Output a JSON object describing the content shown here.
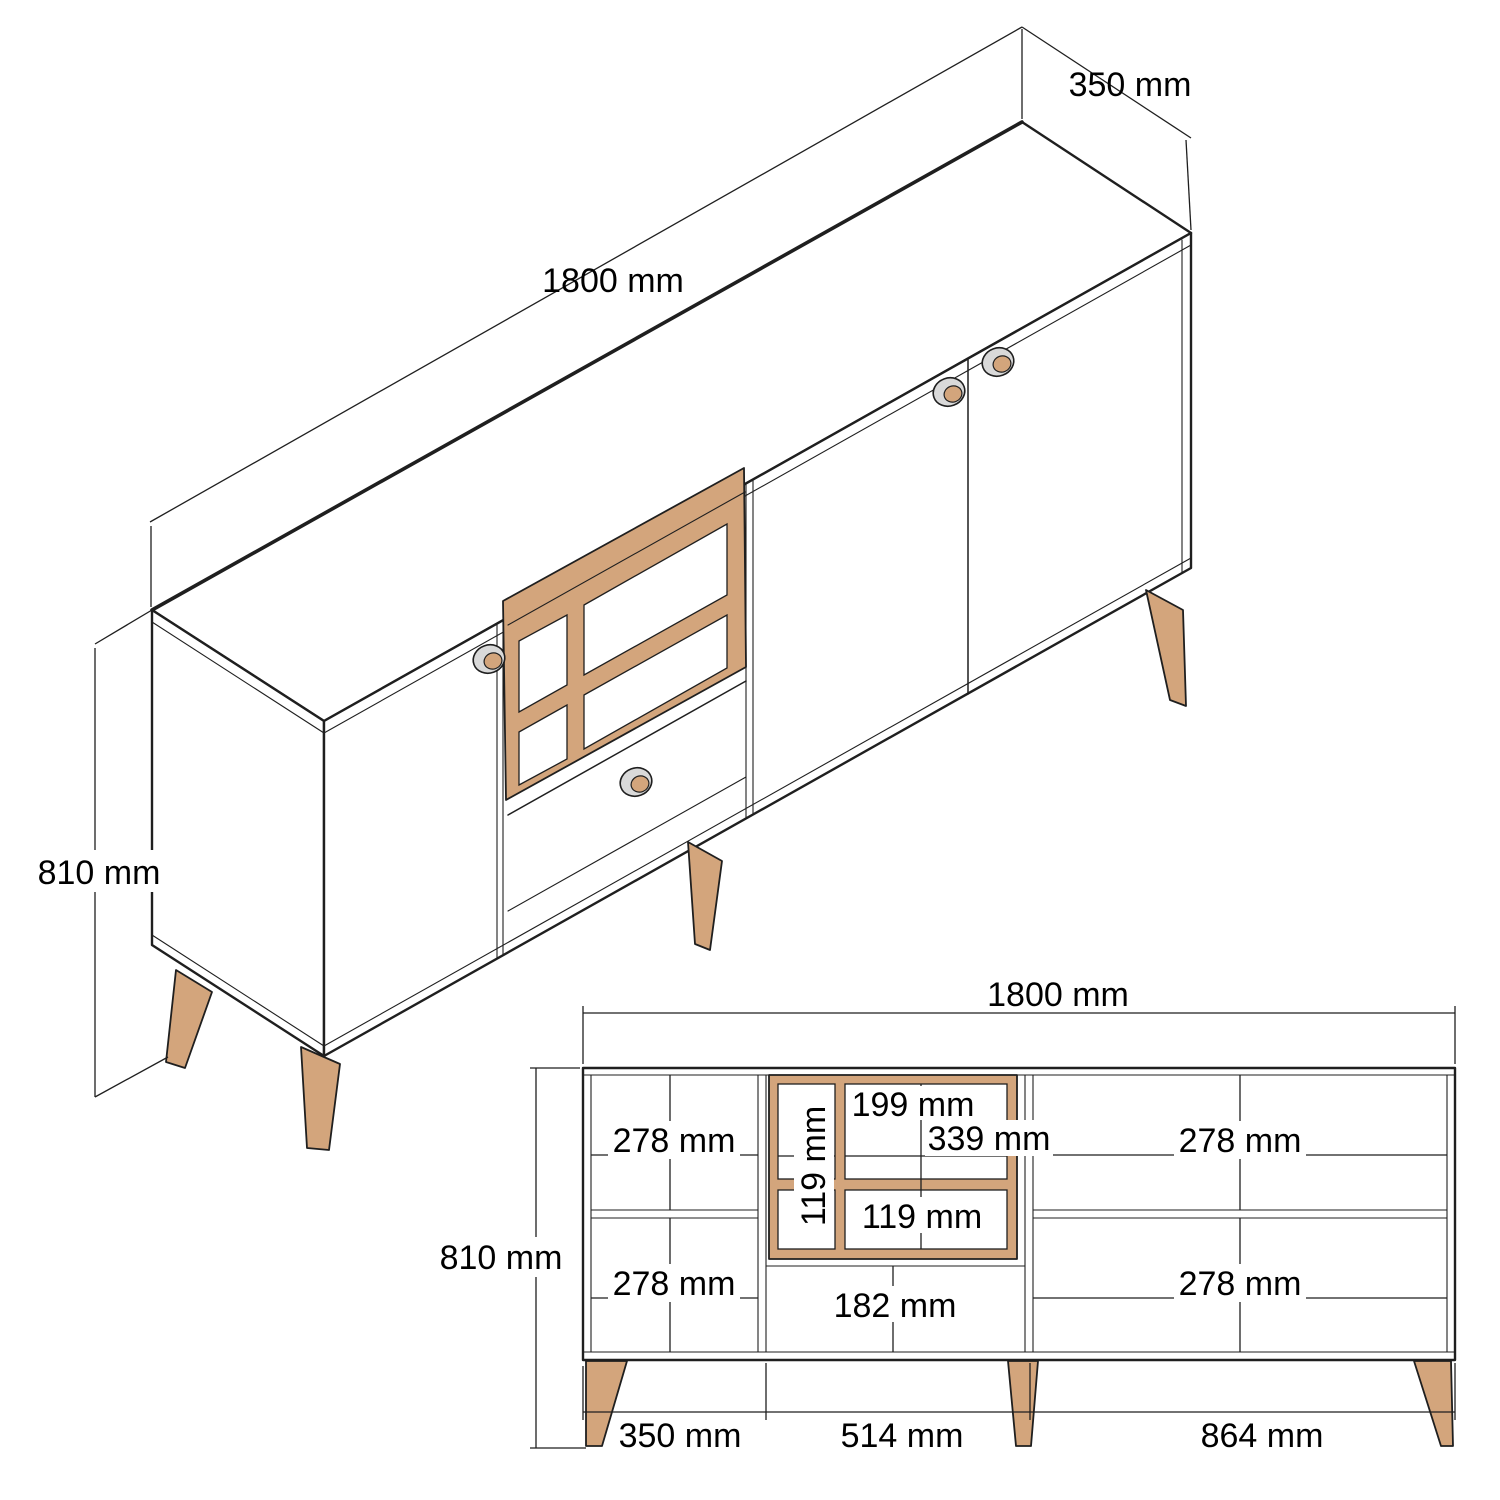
{
  "colors": {
    "background": "#ffffff",
    "line": "#1f1f1f",
    "wood": "#d3a57c",
    "handle_ring": "#d9d9d9",
    "text": "#000000"
  },
  "isometric_view": {
    "width": "1800 mm",
    "depth": "350 mm",
    "height": "810 mm"
  },
  "front_view": {
    "width": "1800 mm",
    "height": "810 mm",
    "left_section": {
      "top": "278 mm",
      "bottom": "278 mm"
    },
    "right_section": {
      "top": "278 mm",
      "bottom": "278 mm"
    },
    "niche": {
      "top_cell_width": "199 mm",
      "inner_width": "339 mm",
      "left_cell_width": "119 mm",
      "bottom_cell_height": "119 mm"
    },
    "drawer": {
      "height": "182 mm"
    },
    "footprint": {
      "left": "350 mm",
      "middle": "514 mm",
      "right": "864 mm"
    }
  }
}
